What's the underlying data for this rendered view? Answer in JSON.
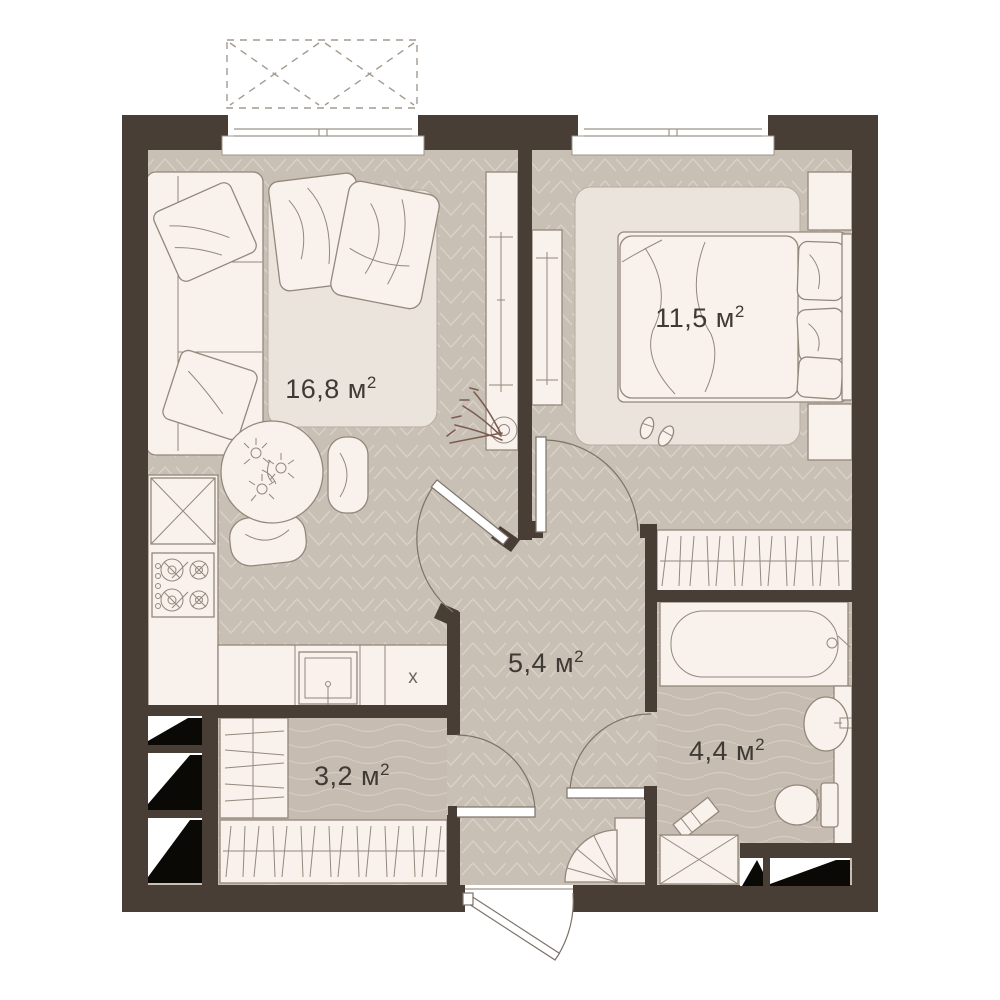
{
  "plan": {
    "title": "apartment-floor-plan",
    "rooms": [
      {
        "id": "living-kitchen",
        "area": "16,8",
        "unit": "м",
        "sup": "2",
        "label_x": 331,
        "label_y": 389
      },
      {
        "id": "bedroom",
        "area": "11,5",
        "unit": "м",
        "sup": "2",
        "label_x": 700,
        "label_y": 318
      },
      {
        "id": "hallway",
        "area": "5,4",
        "unit": "м",
        "sup": "2",
        "label_x": 546,
        "label_y": 663
      },
      {
        "id": "wardrobe-room",
        "area": "3,2",
        "unit": "м",
        "sup": "2",
        "label_x": 352,
        "label_y": 776
      },
      {
        "id": "bathroom",
        "area": "4,4",
        "unit": "м",
        "sup": "2",
        "label_x": 727,
        "label_y": 751
      }
    ],
    "markers": {
      "kitchen_x": "x"
    },
    "colors": {
      "wall": "#483e36",
      "floor_wood": "#c9c0b5",
      "floor_wet": "#c6bcb1",
      "pattern_line": "#d9d2c8",
      "furniture": "#f8f1ec",
      "outline": "#93887c",
      "rug": "#eae4dc",
      "plant": "#7b5c50",
      "shaft": "#0b0906",
      "label_text": "#3f3a35"
    },
    "legend": {
      "balcony": "dashed-balcony-outline",
      "shaft_hatch": "black-wedge-shaft-cells"
    }
  }
}
